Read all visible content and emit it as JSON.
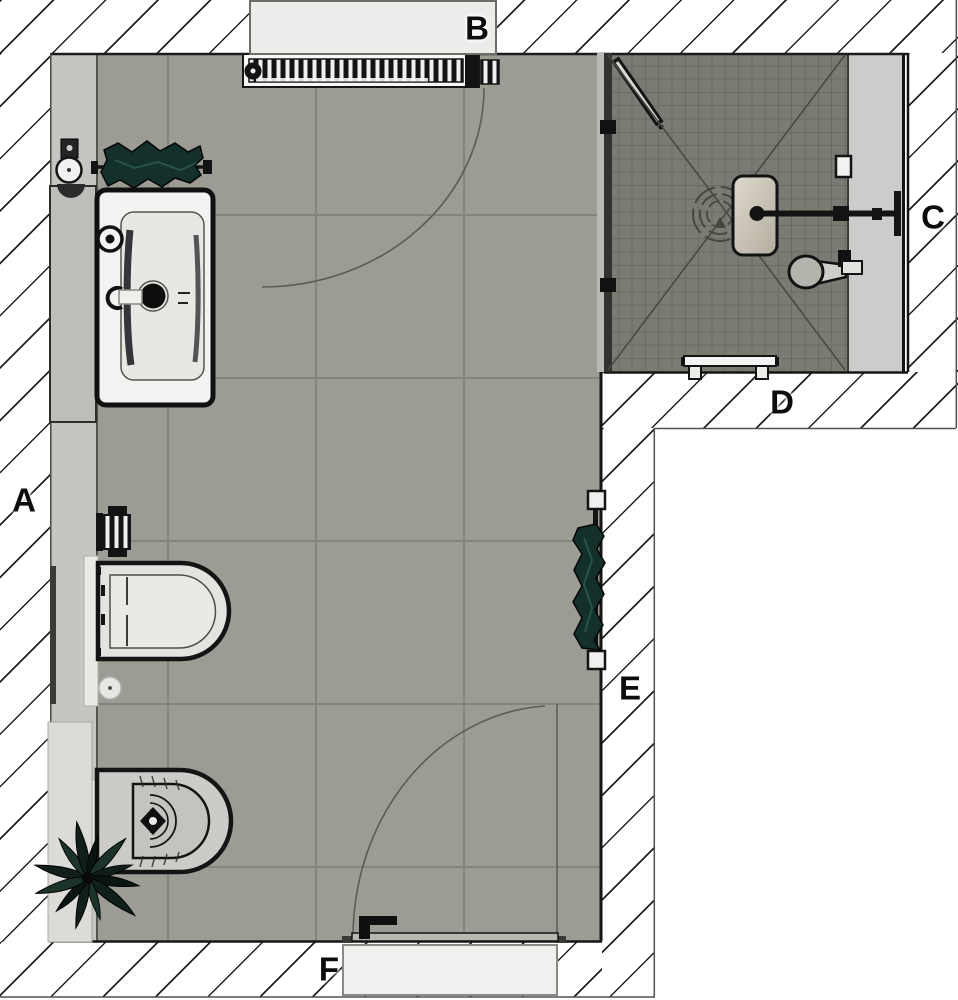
{
  "title": "Bathroom floor plan",
  "labels": {
    "a": {
      "text": "A"
    },
    "b": {
      "text": "B"
    },
    "c": {
      "text": "C"
    },
    "d": {
      "text": "D"
    },
    "e": {
      "text": "E"
    },
    "f": {
      "text": "F"
    }
  },
  "fixtures": [
    "washbasin-vanity",
    "faucet",
    "radiator",
    "window",
    "towel-rail-left",
    "toilet-roll-holder",
    "wall-hung-toilet",
    "floor-drain",
    "bidet",
    "plant",
    "walk-in-shower",
    "glass-partition",
    "glass-door",
    "rain-shower-head",
    "shower-arm",
    "hand-shower",
    "shower-bench",
    "wall-niche",
    "towel-rail-right",
    "entry-door",
    "door-swing-arc",
    "window-swing-arc"
  ],
  "colors": {
    "floor_main": "#9c9c94",
    "floor_grout": "#84847d",
    "floor_shower": "#7b7b73",
    "ledge": "#c5c5c2",
    "shower_band": "#cccccb",
    "towel": "#14302b",
    "plant": "#101f19",
    "outline": "#141414",
    "hatch_line": "#212121",
    "window_fill": "#ececea"
  }
}
